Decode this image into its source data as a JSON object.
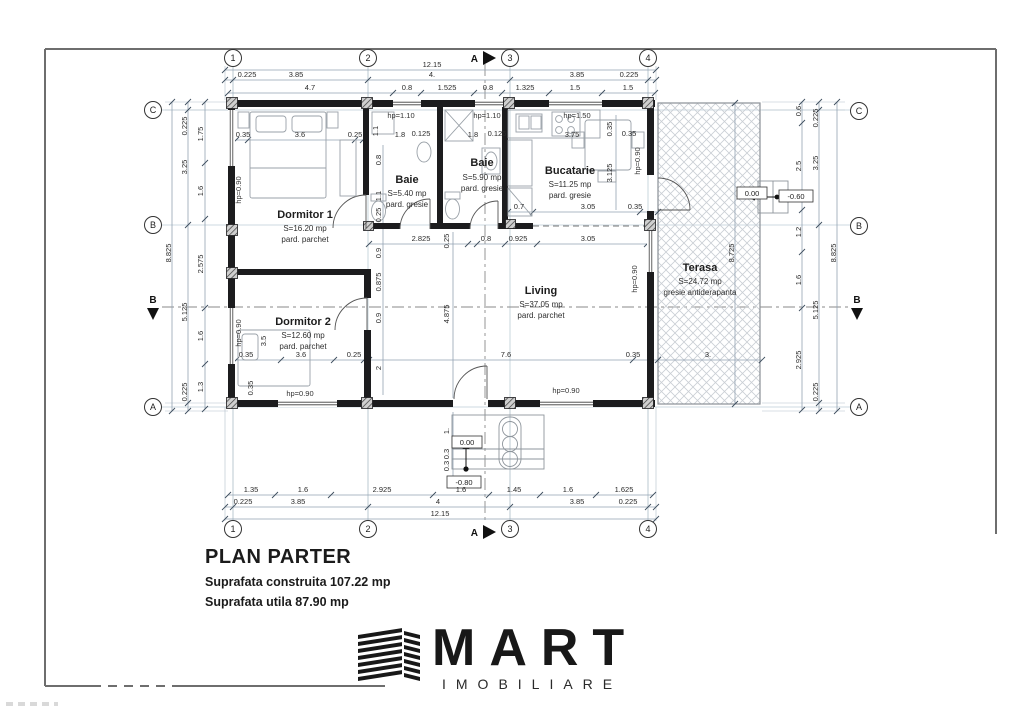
{
  "title_block": {
    "title": "PLAN PARTER",
    "construita": "Suprafata construita 107.22 mp",
    "utila": "Suprafata utila 87.90 mp"
  },
  "logo": {
    "brand": "MART",
    "subtitle": "IMOBILIARE"
  },
  "grid": {
    "cols": [
      "1",
      "2",
      "3",
      "4"
    ],
    "rows": [
      "C",
      "B",
      "A"
    ],
    "section_a": "A",
    "section_b": "B"
  },
  "rooms": {
    "dormitor1": {
      "name": "Dormitor 1",
      "area": "S=16.20 mp",
      "floor": "pard. parchet"
    },
    "dormitor2": {
      "name": "Dormitor 2",
      "area": "S=12.60 mp",
      "floor": "pard. parchet"
    },
    "baie1": {
      "name": "Baie",
      "area": "S=5.40 mp",
      "floor": "pard. gresie"
    },
    "baie2": {
      "name": "Baie",
      "area": "S=5.90 mp",
      "floor": "pard. gresie"
    },
    "bucatarie": {
      "name": "Bucatarie",
      "area": "S=11.25 mp",
      "floor": "pard. gresie"
    },
    "living": {
      "name": "Living",
      "area": "S=37.05 mp",
      "floor": "pard. parchet"
    },
    "terasa": {
      "name": "Terasa",
      "area": "S=24.72 mp",
      "floor": "gresie antiderapanta"
    }
  },
  "dims": {
    "total": "12.15",
    "top2": [
      "0.225",
      "3.85",
      "4.",
      "3.85",
      "0.225"
    ],
    "top3": [
      "4.7",
      "0.8",
      "1.525",
      "0.8",
      "1.325",
      "1.5",
      "1.5"
    ],
    "bot1": [
      "1.35",
      "1.6",
      "2.925",
      "1.6",
      "1.45",
      "1.6",
      "1.625"
    ],
    "bot2": [
      "0.225",
      "3.85",
      "4",
      "3.85",
      "0.225"
    ],
    "left_outer": "8.825",
    "left_mid": [
      "0.225",
      "3.25",
      "5.125",
      "0.225"
    ],
    "left_inner": [
      "1.75",
      "1.6",
      "2.575",
      "1.6",
      "1.3"
    ],
    "right_outer": "8.825",
    "right_mid": [
      "0.225",
      "3.25",
      "5.125",
      "0.225"
    ],
    "right_inner": [
      "0.6",
      "2.5",
      "1.2",
      "1.6",
      "2.925"
    ],
    "terasa_h": "8.725",
    "terasa_w": "3.",
    "d1_row": [
      "0.35",
      "3.6",
      "0.25"
    ],
    "baie_row": [
      "1.1",
      "1.8",
      "0.125",
      "1.8",
      "0.125"
    ],
    "kit_row": [
      "3.75",
      "0.35"
    ],
    "kit_v": [
      "0.35",
      "3.125"
    ],
    "kit_bot": [
      "0.7",
      "3.05",
      "0.35"
    ],
    "hall_row": [
      "2.825",
      "0.25",
      "0.8",
      "0.925",
      "3.05"
    ],
    "d1_v": [
      "0.8",
      "1.1",
      "0.25"
    ],
    "mid_v": [
      "0.9",
      "0.875",
      "0.9",
      "2"
    ],
    "liv_w": "7.6",
    "liv_wall": "0.35",
    "liv_h": "4.875",
    "d2_row": [
      "0.35",
      "3.6",
      "0.25"
    ],
    "d2_bed": "3.5",
    "d2_side": "0.35",
    "entry_v": [
      "1.",
      "0.3",
      "0.3"
    ]
  },
  "annotations": {
    "hp090": "hp=0.90",
    "hp110": "hp=1.10",
    "hp150": "hp=1.50",
    "lvl0": "0.00",
    "lvl_m080": "-0.80",
    "lvl_m060": "-0.60"
  }
}
